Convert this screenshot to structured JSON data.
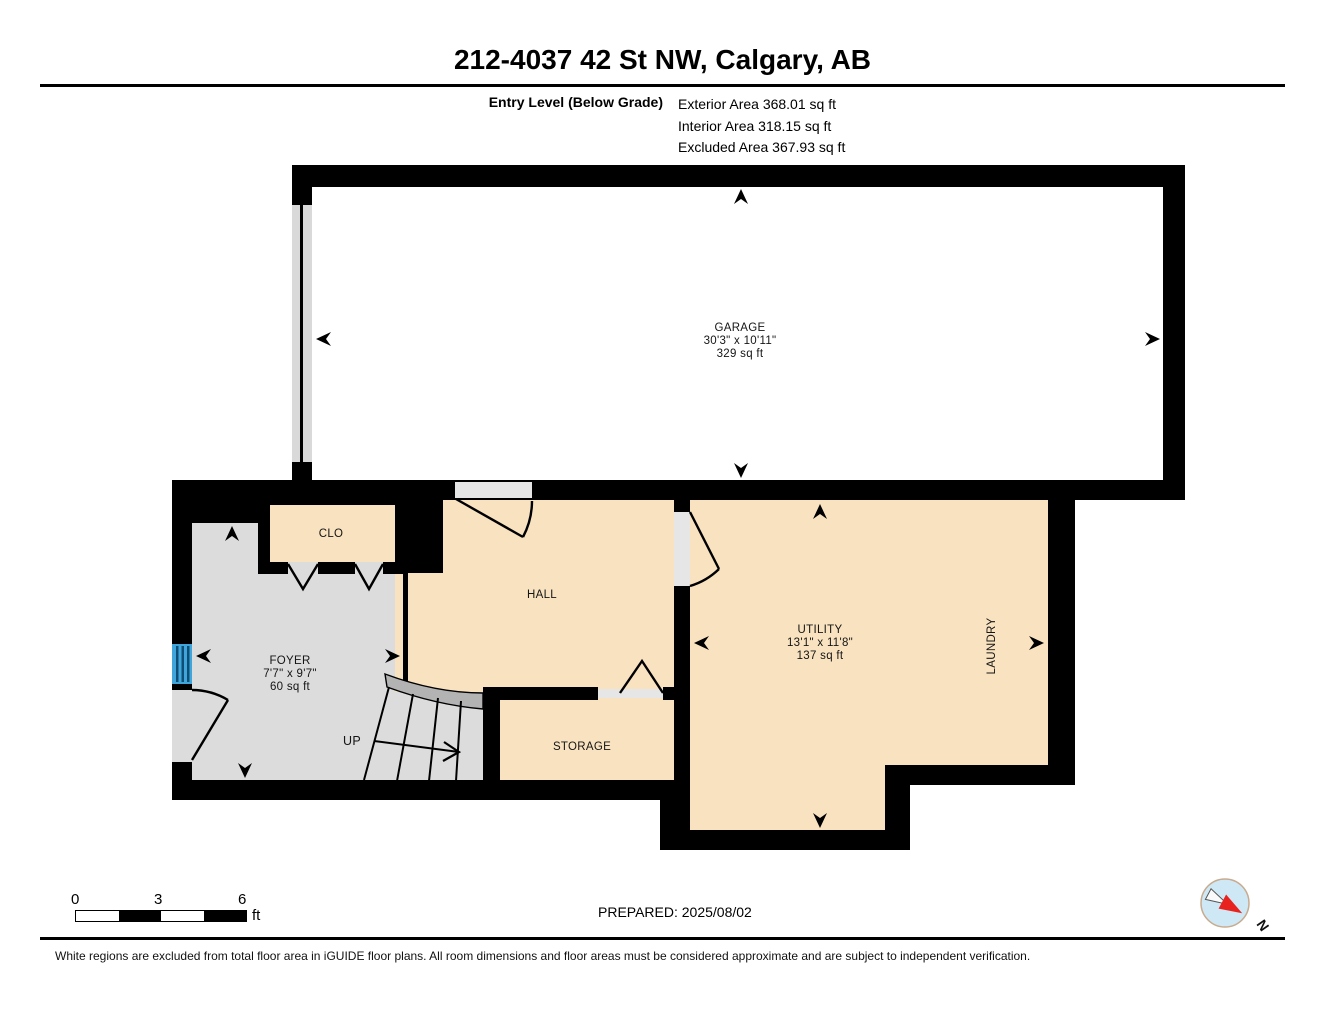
{
  "header": {
    "title": "212-4037 42 St NW, Calgary, AB"
  },
  "level": {
    "name": "Entry Level (Below Grade)",
    "exterior": "Exterior Area 368.01 sq ft",
    "interior": "Interior Area 318.15 sq ft",
    "excluded": "Excluded Area 367.93 sq ft"
  },
  "rooms": {
    "garage": {
      "name": "GARAGE",
      "dims": "30'3\" x 10'11\"",
      "area": "329 sq ft"
    },
    "foyer": {
      "name": "FOYER",
      "dims": "7'7\" x 9'7\"",
      "area": "60 sq ft"
    },
    "clo": {
      "name": "CLO"
    },
    "hall": {
      "name": "HALL"
    },
    "storage": {
      "name": "STORAGE"
    },
    "utility": {
      "name": "UTILITY",
      "dims": "13'1\" x 11'8\"",
      "area": "137 sq ft"
    },
    "laundry": {
      "name": "LAUNDRY"
    },
    "stairs": {
      "up_label": "UP"
    }
  },
  "scale_bar": {
    "tick0": "0",
    "tick3": "3",
    "tick6": "6",
    "unit": "ft"
  },
  "compass": {
    "north_label": "N"
  },
  "footer": {
    "prepared": "PREPARED: 2025/08/02",
    "disclaimer": "White regions are excluded from total floor area in iGUIDE floor plans. All room dimensions and floor areas must be considered approximate and are subject to independent verification."
  },
  "colors": {
    "interior_room": "#f9e2c0",
    "excluded_room": "#dcdcdc",
    "wall": "#000000",
    "window": "#3fa5da",
    "compass_needle": "#e8231f"
  }
}
